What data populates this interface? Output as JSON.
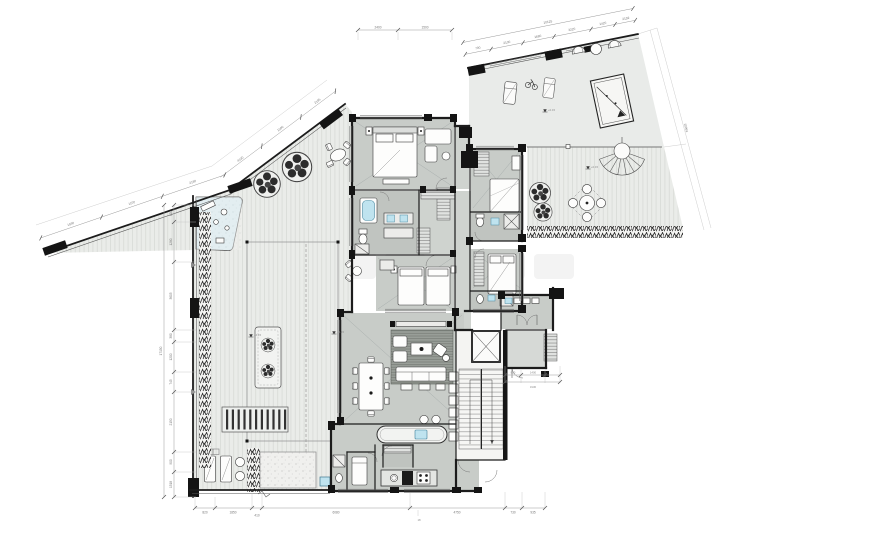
{
  "palette": {
    "terrace_deck": "#e9ebe9",
    "interior_floor": "#c8ccc8",
    "wet_room_floor": "#c0c4c0",
    "foyer_floor": "#d6d9d6",
    "wall": "#1c1c1c",
    "water_blue": "#bfe3ef",
    "water_blue_deep": "#5fa8c4",
    "rug": "#979c97",
    "dimension_gray": "#8c8c8c",
    "planting_black": "#1f1f1f",
    "watermark_gray": "#b9b9b9"
  },
  "dims": {
    "left": [
      "620",
      "1280",
      "3605",
      "380",
      "1200",
      "745",
      "2150",
      "900",
      "1518"
    ],
    "left_total": "17150",
    "tl": [
      "1590",
      "1100",
      "2180",
      "4330",
      "1580",
      "2185"
    ],
    "tr": [
      "700",
      "2100",
      "1680",
      "3220",
      "1420",
      "2159"
    ],
    "tr_total": "10125",
    "house_top": [
      "2400",
      "1500"
    ],
    "bottom": [
      "820",
      "1850",
      "410",
      "6080",
      "4750",
      "730",
      "935"
    ],
    "bottom_sub": "18",
    "entry": [
      "800",
      "1400",
      "3130"
    ],
    "right_side": "20963"
  },
  "levels": [
    "+4.15",
    "+4.15",
    "+0.15",
    "+0.15"
  ]
}
